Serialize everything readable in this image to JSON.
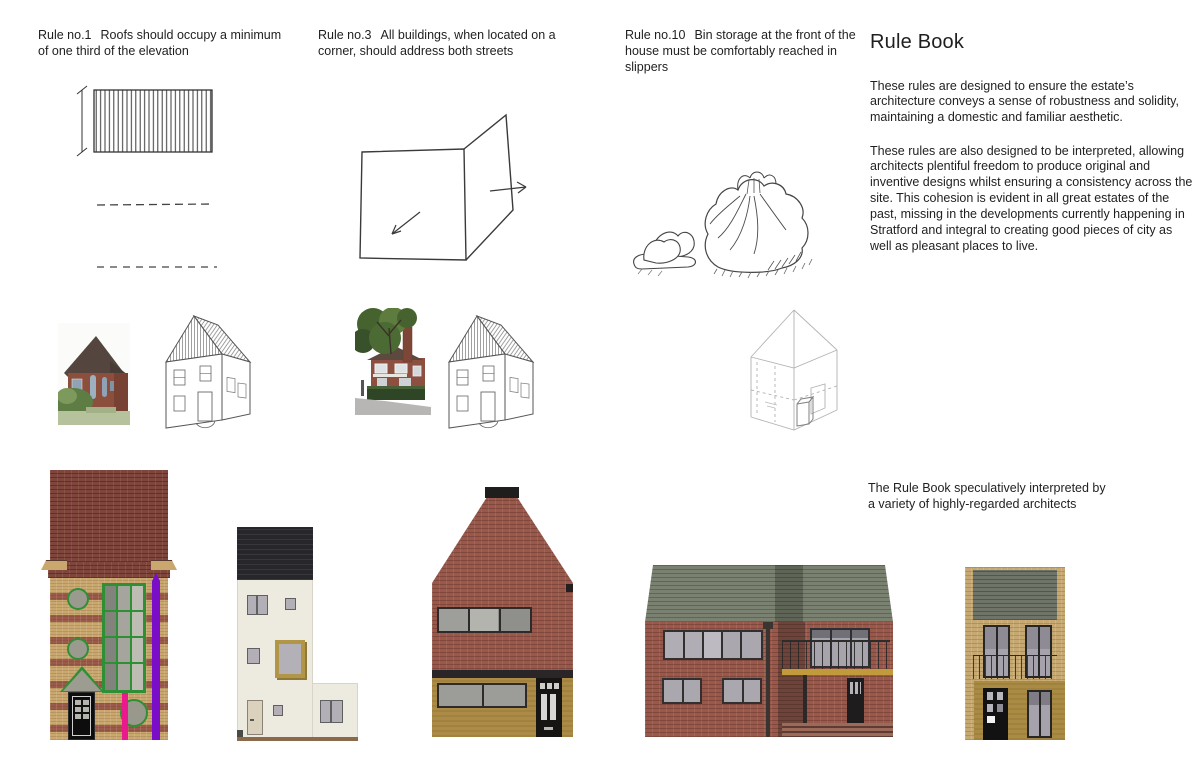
{
  "title": "Rule Book",
  "intro": {
    "p1": "These rules are designed to ensure the estate’s architecture conveys a sense of robustness and solidity, maintaining a domestic and familiar aesthetic.",
    "p2": "These rules are also designed to be interpreted, allowing architects plentiful freedom to produce original and inventive designs whilst ensuring a consistency across the site.  This cohesion is evident in all great estates of the past, missing in the developments currently happening in Stratford and integral to creating good pieces of city as well as pleasant places to live."
  },
  "caption": {
    "line1": "The Rule Book speculatively interpreted by",
    "line2": "a variety of highly-regarded architects"
  },
  "rules": [
    {
      "label": "Rule no.1",
      "text": "Roofs should occupy a minimum of one third of the elevation"
    },
    {
      "label": "Rule no.3",
      "text": "All buildings, when located on a corner, should address both streets"
    },
    {
      "label": "Rule no.10",
      "text": "Bin storage at the front of the house must be comfortably reached in slippers"
    }
  ],
  "palette": {
    "sketch_ink": "#3d3d3d",
    "faint_line": "#b3b3b3",
    "brick_dark_red": "#7e453c",
    "brick_red": "#9a584a",
    "brick_buff": "#c9a76d",
    "buff_brick_light": "#c6a873",
    "stripe_purple": "#7a0dc8",
    "stripe_pink": "#ea1a8c",
    "frame_green": "#2f8f35",
    "roof_black": "#27262b",
    "wall_cream": "#edebe0",
    "window_gold": "#b09646",
    "ground_ochre": "#ab8b45",
    "roof_green_grey": "#7a8170",
    "balcony_gold": "#c19b3b"
  }
}
